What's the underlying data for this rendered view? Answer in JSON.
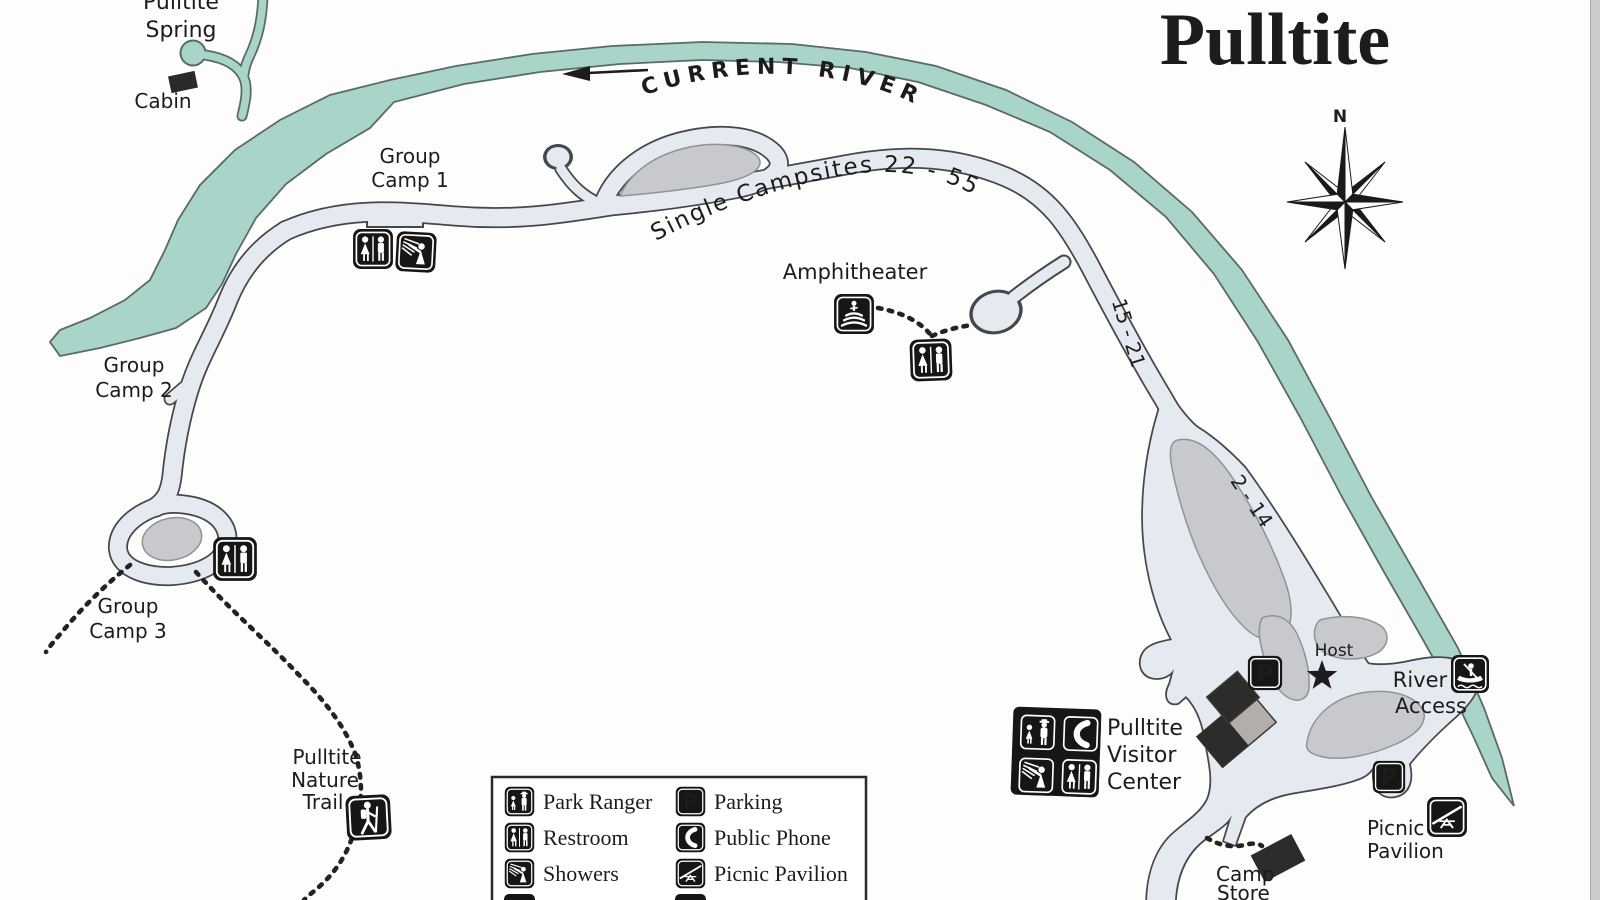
{
  "title": "Pulltite",
  "compass": {
    "north": "N"
  },
  "colors": {
    "river": "#a9d4ca",
    "river_outline": "#5a6a64",
    "road": "#e4eaf0",
    "road_outline": "#43484c",
    "island": "#c7c9cc",
    "icon_background": "#161616",
    "ink": "#1c1c1c"
  },
  "river": {
    "name": "CURRENT RIVER"
  },
  "map_labels": {
    "spring_line1": "Pulltite",
    "spring_line2": "Spring",
    "cabin": "Cabin",
    "gc1_line1": "Group",
    "gc1_line2": "Camp 1",
    "gc2_line1": "Group",
    "gc2_line2": "Camp 2",
    "gc3_line1": "Group",
    "gc3_line2": "Camp 3",
    "single_campsites": "Single Campsites 22 - 55",
    "sites_15_21": "15 - 21",
    "sites_2_14": "2 - 14",
    "amphitheater": "Amphitheater",
    "host": "Host",
    "river_access_line1": "River",
    "river_access_line2": "Access",
    "visitor_center_line1": "Pulltite",
    "visitor_center_line2": "Visitor",
    "visitor_center_line3": "Center",
    "picnic_line1": "Picnic",
    "picnic_line2": "Pavilion",
    "camp_store_line1": "Camp",
    "camp_store_line2": "Store",
    "nature_trail_line1": "Pulltite",
    "nature_trail_line2": "Nature",
    "nature_trail_line3": "Trail"
  },
  "icons": {
    "parking_letter": "P"
  },
  "legend": {
    "left": [
      {
        "icon": "park-ranger",
        "label": "Park Ranger"
      },
      {
        "icon": "restroom",
        "label": "Restroom"
      },
      {
        "icon": "showers",
        "label": "Showers"
      }
    ],
    "right": [
      {
        "icon": "parking",
        "label": "Parking"
      },
      {
        "icon": "public-phone",
        "label": "Public Phone"
      },
      {
        "icon": "picnic-pavilion",
        "label": "Picnic Pavilion"
      }
    ]
  }
}
